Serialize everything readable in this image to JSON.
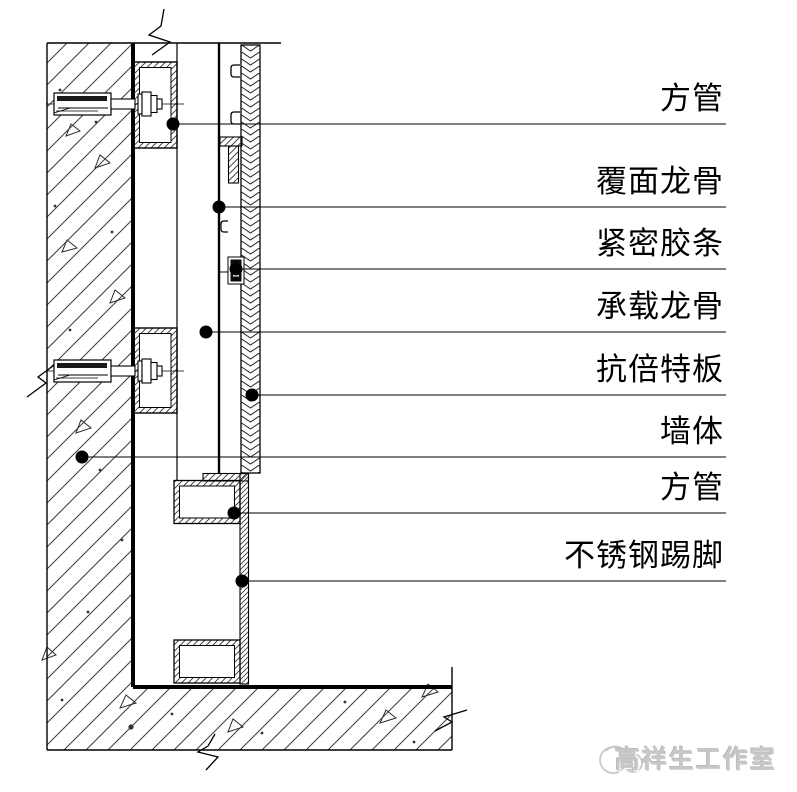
{
  "drawing": {
    "labels": [
      {
        "id": "square-tube-upper",
        "text": "方管"
      },
      {
        "id": "facing-keel",
        "text": "覆面龙骨"
      },
      {
        "id": "sealing-gasket",
        "text": "紧密胶条"
      },
      {
        "id": "load-bearing-keel",
        "text": "承载龙骨"
      },
      {
        "id": "compact-laminate-panel",
        "text": "抗倍特板"
      },
      {
        "id": "wall-body",
        "text": "墙体"
      },
      {
        "id": "square-tube-lower",
        "text": "方管"
      },
      {
        "id": "stainless-steel-skirting",
        "text": "不锈钢踢脚"
      }
    ]
  },
  "watermark": {
    "text": "高祥生工作室"
  },
  "colors": {
    "line": "#000000",
    "background": "#ffffff",
    "watermark_gray": "#c8c8c8"
  }
}
